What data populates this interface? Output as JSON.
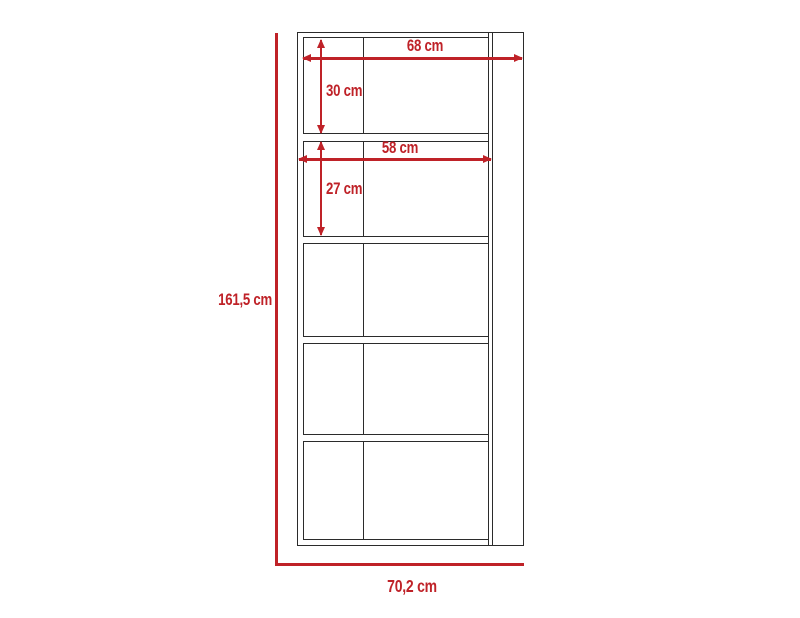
{
  "diagram": {
    "type": "furniture-dimension-drawing",
    "colors": {
      "dimension_accent": "#bf2228",
      "outline": "#2b2b2b",
      "background": "#ffffff"
    },
    "dimensions": {
      "overall_height": "161,5 cm",
      "overall_width": "70,2 cm",
      "top_section_width": "68 cm",
      "top_section_height": "30 cm",
      "second_section_width": "58 cm",
      "second_section_height": "27 cm"
    }
  }
}
